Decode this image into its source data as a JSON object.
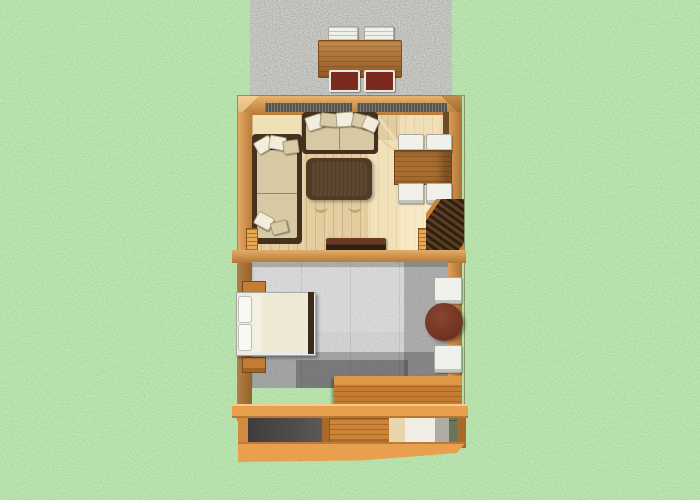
{
  "scene": {
    "description": "3D rendered top-down dollhouse floor plan of a small cabin on a grass lawn",
    "outdoor": {
      "ground": "grass-lawn",
      "patio": {
        "surface": "gravel",
        "furniture": [
          "picnic-table",
          "two-white-chairs-top",
          "two-maroon-chairs-bottom"
        ]
      }
    },
    "rooms": [
      {
        "name": "living-room",
        "floor": "light-wood-planks",
        "furniture": [
          "top-sofa",
          "left-loveseat",
          "coffee-table",
          "dining-table",
          "four-dining-chairs",
          "sideboard",
          "staircase",
          "entry-door-arc",
          "kitchen-counter"
        ]
      },
      {
        "name": "bedroom",
        "floor": "gray-carpet",
        "furniture": [
          "double-bed",
          "two-nightstands",
          "round-table",
          "two-white-chairs",
          "storage-cabinet"
        ]
      },
      {
        "name": "lower-level-cutaway",
        "furniture": [
          "dresser",
          "appliance"
        ]
      }
    ]
  },
  "palette": {
    "grass": "#7FC163",
    "gravel": "#8B8A85",
    "wall": "#D28A3E",
    "wallLight": "#E9A855",
    "wallDark": "#A86A2A",
    "wallInner": "#6F4A26",
    "deck": "#E9A04E",
    "woodFloor": "#E3CD9F",
    "woodFloorLight": "#F4E7C2",
    "counter": "#EFE0B5",
    "sofaFrame": "#46301E",
    "cushion": "#D6C9A3",
    "pillow": "#F2EDDC",
    "pillowTan": "#D8CCA8",
    "coffeeTable": "#513B27",
    "coffeeTableTop": "#5E4730",
    "diningTable": "#A86D30",
    "chairWhite": "#F1F1EB",
    "chairMaroon": "#7B2B1E",
    "picnicTable": "#B06E2E",
    "stairTread": "#2C2013",
    "stairMid": "#5E3E22",
    "stairRail": "#C9853B",
    "carpet": "#9C9C9C",
    "bedFrame": "#EAEAE7",
    "mattress": "#DFD3AE",
    "footboard": "#3A2B1B",
    "nightstand": "#C47E33",
    "roundTable": "#6E3320",
    "roundTableHi": "#8A4530",
    "cabinet": "#C67B31",
    "cabinetTop": "#DE9845",
    "dresser": "#CE8336",
    "backWall": "#4E4D4B",
    "appliance": "#E9E4D6"
  }
}
